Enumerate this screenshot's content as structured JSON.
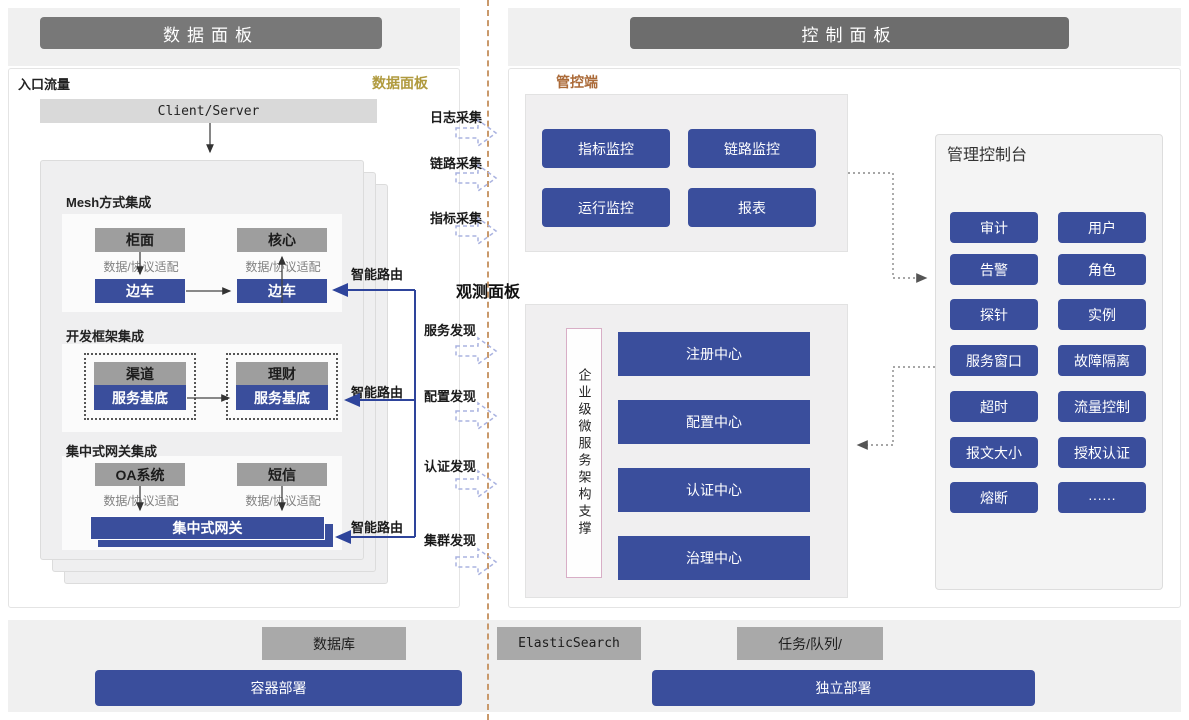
{
  "headers": {
    "left": "数据面板",
    "right": "控制面板"
  },
  "left_panel": {
    "corner_label": "入口流量",
    "tag": "数据面板",
    "client_server": "Client/Server",
    "adapter_label": "数据/协议适配",
    "smart_route_label": "智能路由",
    "mesh": {
      "title": "Mesh方式集成",
      "top_left": "柜面",
      "top_right": "核心",
      "bottom_left": "边车",
      "bottom_right": "边车"
    },
    "framework": {
      "title": "开发框架集成",
      "left_top": "渠道",
      "left_bottom": "服务基底",
      "right_top": "理财",
      "right_bottom": "服务基底"
    },
    "gateway": {
      "title": "集中式网关集成",
      "top_left": "OA系统",
      "top_right": "短信",
      "bar": "集中式网关"
    }
  },
  "middle": {
    "collect": [
      "日志采集",
      "链路采集",
      "指标采集"
    ],
    "observe_title": "观测面板",
    "discover": [
      "服务发现",
      "配置发现",
      "认证发现",
      "集群发现"
    ]
  },
  "control": {
    "tag": "管控端",
    "monitors": [
      "指标监控",
      "链路监控",
      "运行监控",
      "报表"
    ],
    "support_vertical": "企业级微服务架构支撑",
    "centers": [
      "注册中心",
      "配置中心",
      "认证中心",
      "治理中心"
    ],
    "console_title": "管理控制台",
    "console_buttons": [
      "审计",
      "用户",
      "告警",
      "角色",
      "探针",
      "实例",
      "服务窗口",
      "故障隔离",
      "超时",
      "流量控制",
      "报文大小",
      "授权认证",
      "熔断",
      "······"
    ]
  },
  "bottom": {
    "database": "数据库",
    "container_deploy": "容器部署",
    "elasticsearch": "ElasticSearch",
    "task_queue": "任务/队列/",
    "standalone_deploy": "独立部署"
  },
  "colors": {
    "accent_blue": "#3a4e9c",
    "gray_box": "#9e9e9e",
    "gold": "#b09a3e",
    "orange": "#ab6a38",
    "separator": "#c9996b"
  }
}
